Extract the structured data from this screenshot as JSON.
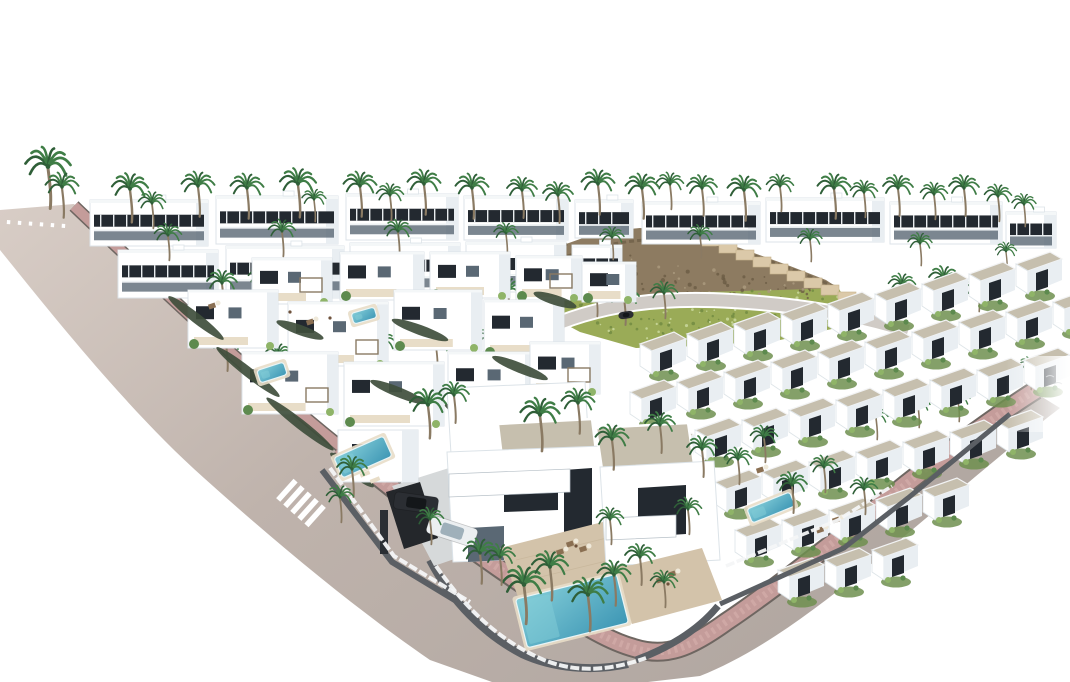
{
  "scene": {
    "description": "Aerial 3D architectural rendering of a white Mediterranean villa development with diagonal roads, pink sidewalks, crosswalks, palm trees, turquoise pools, parked cars, terraced townhouse rows and a rocky green hillside on a white background"
  },
  "colors": {
    "background": "#ffffff",
    "road_top": "#d8cdc6",
    "road_mid": "#bfb3ac",
    "road_end": "#b1a7a1",
    "street": "#d0cbc6",
    "sidewalk": "#c49c9a",
    "sidewalk_light": "#d8b3ae",
    "curb": "#6e6661",
    "wall_dark": "#5b5f64",
    "fence_white": "#f4f6f7",
    "villa_white": "#ffffff",
    "villa_shade": "#e9eef2",
    "villa_edge": "#b9c2c9",
    "window_dark": "#232930",
    "glass": "#5a6874",
    "mullion": "#e8ecef",
    "roof_gravel": "#c6bfae",
    "roof_dark": "#aaa394",
    "terrace": "#d3c3aa",
    "terrace_light": "#e8ddc8",
    "hedge": "#3f4e3c",
    "garden_green": "#6f8f4f",
    "tree_green": "#5d8a4e",
    "tree_light": "#8fb468",
    "grass": "#9aab57",
    "grass_dark": "#6f8a41",
    "grass_light": "#c8d69a",
    "rock": "#8d7b61",
    "rock_dark": "#6b5c45",
    "wall_beige": "#dbc9a9",
    "pool": "#4aa9c2",
    "pool_light": "#83cdd8",
    "palm_green": "#3f7d46",
    "palm_dark": "#2f5f38",
    "trunk": "#8a7a63",
    "car_dark": "#2b2e33",
    "car_white": "#eceff1",
    "furniture": "#8a6f52",
    "driveway": "#d6d9da",
    "carport": "#24272b"
  },
  "elements": {
    "top_buildings": [
      [
        90,
        200,
        118,
        46
      ],
      [
        216,
        196,
        122,
        48
      ],
      [
        346,
        194,
        112,
        46
      ],
      [
        464,
        196,
        104,
        44
      ],
      [
        575,
        200,
        58,
        38
      ],
      [
        642,
        202,
        118,
        42
      ],
      [
        766,
        198,
        118,
        44
      ],
      [
        890,
        202,
        112,
        42
      ],
      [
        1006,
        212,
        50,
        36
      ],
      [
        118,
        250,
        100,
        48
      ],
      [
        226,
        246,
        118,
        52
      ],
      [
        350,
        243,
        110,
        52
      ],
      [
        466,
        242,
        100,
        50
      ],
      [
        572,
        245,
        50,
        42
      ]
    ],
    "left_villas": [
      [
        252,
        258,
        80,
        46
      ],
      [
        340,
        252,
        84,
        48
      ],
      [
        430,
        252,
        80,
        46
      ],
      [
        516,
        256,
        66,
        44
      ],
      [
        582,
        262,
        54,
        40
      ],
      [
        188,
        290,
        90,
        58
      ],
      [
        288,
        302,
        100,
        64
      ],
      [
        394,
        290,
        88,
        60
      ],
      [
        484,
        300,
        80,
        56
      ],
      [
        242,
        352,
        96,
        62
      ],
      [
        344,
        362,
        100,
        64
      ],
      [
        448,
        352,
        88,
        58
      ],
      [
        530,
        342,
        70,
        52
      ]
    ],
    "townhouse_rows": [
      {
        "x": 640,
        "y": 332,
        "n": 9
      },
      {
        "x": 630,
        "y": 380,
        "n": 10
      },
      {
        "x": 648,
        "y": 428,
        "n": 10
      },
      {
        "x": 715,
        "y": 470,
        "n": 7
      },
      {
        "x": 735,
        "y": 518,
        "n": 5
      },
      {
        "x": 778,
        "y": 558,
        "n": 3
      }
    ],
    "palms_back": [
      [
        48,
        168,
        1.5
      ],
      [
        62,
        188,
        1.1
      ],
      [
        130,
        190,
        1.2
      ],
      [
        152,
        204,
        0.9
      ],
      [
        198,
        187,
        1.1
      ],
      [
        247,
        189,
        1.1
      ],
      [
        298,
        185,
        1.2
      ],
      [
        314,
        200,
        0.8
      ],
      [
        360,
        187,
        1.1
      ],
      [
        390,
        196,
        0.9
      ],
      [
        424,
        185,
        1.1
      ],
      [
        472,
        189,
        1.1
      ],
      [
        522,
        191,
        1.0
      ],
      [
        558,
        196,
        1.0
      ],
      [
        598,
        185,
        1.1
      ],
      [
        642,
        189,
        1.1
      ],
      [
        670,
        185,
        0.9
      ],
      [
        702,
        189,
        1.0
      ],
      [
        744,
        191,
        1.1
      ],
      [
        780,
        187,
        0.9
      ],
      [
        834,
        189,
        1.1
      ],
      [
        864,
        193,
        0.9
      ],
      [
        898,
        189,
        1.0
      ],
      [
        934,
        195,
        0.9
      ],
      [
        964,
        189,
        1.0
      ],
      [
        998,
        197,
        0.9
      ],
      [
        1024,
        205,
        0.8
      ],
      [
        168,
        236,
        0.9
      ],
      [
        282,
        232,
        0.9
      ],
      [
        398,
        232,
        0.9
      ],
      [
        506,
        234,
        0.8
      ],
      [
        612,
        238,
        0.8
      ],
      [
        700,
        236,
        0.8
      ],
      [
        810,
        240,
        0.8
      ],
      [
        920,
        244,
        0.8
      ],
      [
        1006,
        252,
        0.7
      ]
    ],
    "palms_mid": [
      [
        222,
        284,
        1.0
      ],
      [
        262,
        278,
        0.9
      ],
      [
        316,
        290,
        1.0
      ],
      [
        402,
        288,
        1.3
      ],
      [
        462,
        286,
        1.1
      ],
      [
        508,
        292,
        1.0
      ],
      [
        556,
        286,
        0.9
      ],
      [
        596,
        292,
        0.9
      ],
      [
        226,
        344,
        1.0
      ],
      [
        278,
        356,
        0.9
      ],
      [
        330,
        352,
        1.0
      ],
      [
        382,
        344,
        0.9
      ],
      [
        436,
        346,
        0.9
      ],
      [
        490,
        340,
        0.9
      ],
      [
        546,
        330,
        0.8
      ],
      [
        624,
        298,
        1.0
      ],
      [
        664,
        294,
        0.9
      ],
      [
        902,
        286,
        0.9
      ],
      [
        944,
        280,
        1.0
      ],
      [
        978,
        290,
        0.8
      ],
      [
        1030,
        368,
        0.8
      ],
      [
        876,
        418,
        0.8
      ],
      [
        918,
        406,
        0.8
      ],
      [
        958,
        400,
        0.8
      ]
    ],
    "palms_front": [
      [
        428,
        406,
        1.2
      ],
      [
        454,
        396,
        1.0
      ],
      [
        540,
        416,
        1.3
      ],
      [
        578,
        404,
        1.1
      ],
      [
        612,
        440,
        1.1
      ],
      [
        660,
        426,
        1.0
      ],
      [
        702,
        450,
        1.0
      ],
      [
        738,
        460,
        0.9
      ],
      [
        764,
        438,
        0.9
      ],
      [
        352,
        470,
        1.0
      ],
      [
        340,
        498,
        0.9
      ],
      [
        480,
        554,
        1.1
      ],
      [
        524,
        586,
        1.4
      ],
      [
        550,
        568,
        1.2
      ],
      [
        588,
        596,
        1.3
      ],
      [
        614,
        576,
        1.1
      ],
      [
        500,
        558,
        1.0
      ],
      [
        640,
        558,
        1.0
      ],
      [
        664,
        583,
        0.9
      ],
      [
        792,
        486,
        1.0
      ],
      [
        824,
        468,
        0.9
      ],
      [
        864,
        490,
        0.9
      ],
      [
        430,
        520,
        0.9
      ],
      [
        610,
        520,
        0.9
      ],
      [
        688,
        510,
        0.9
      ]
    ],
    "pools": [
      {
        "x": 336,
        "y": 446,
        "w": 54,
        "h": 22,
        "r": -24
      },
      {
        "x": 258,
        "y": 366,
        "w": 28,
        "h": 13,
        "r": -18
      },
      {
        "x": 352,
        "y": 310,
        "w": 24,
        "h": 11,
        "r": -16
      },
      {
        "x": 520,
        "y": 586,
        "w": 104,
        "h": 50,
        "r": -14
      },
      {
        "x": 748,
        "y": 500,
        "w": 46,
        "h": 15,
        "r": -22
      }
    ],
    "cars": [
      {
        "x": 416,
        "y": 503,
        "rot": 8,
        "type": "dark",
        "l": 44,
        "wd": 17
      },
      {
        "x": 452,
        "y": 531,
        "rot": 18,
        "type": "white",
        "l": 50,
        "wd": 19
      },
      {
        "x": 626,
        "y": 315,
        "rot": -8,
        "type": "dark",
        "l": 15,
        "wd": 7
      }
    ],
    "crosswalks": [
      {
        "cx": 36,
        "cy": 224,
        "angle": 4,
        "count": 6,
        "len": 4,
        "w": 3.4,
        "gap": 11
      },
      {
        "cx": 301,
        "cy": 503,
        "angle": 42,
        "count": 5,
        "len": 26,
        "w": 5.5,
        "gap": 9.5
      }
    ],
    "hedges": [
      {
        "x": 196,
        "y": 318,
        "l": 70,
        "rot": 38
      },
      {
        "x": 248,
        "y": 372,
        "l": 80,
        "rot": 38
      },
      {
        "x": 300,
        "y": 424,
        "l": 85,
        "rot": 38
      },
      {
        "x": 352,
        "y": 470,
        "l": 55,
        "rot": 38
      },
      {
        "x": 420,
        "y": 330,
        "l": 60,
        "rot": 20
      },
      {
        "x": 520,
        "y": 368,
        "l": 60,
        "rot": 22
      },
      {
        "x": 300,
        "y": 330,
        "l": 50,
        "rot": 20
      },
      {
        "x": 398,
        "y": 392,
        "l": 60,
        "rot": 22
      },
      {
        "x": 470,
        "y": 416,
        "l": 55,
        "rot": 24
      },
      {
        "x": 555,
        "y": 300,
        "l": 45,
        "rot": 18
      }
    ],
    "furniture": [
      [
        570,
        544
      ],
      [
        583,
        549
      ],
      [
        560,
        552
      ],
      [
        660,
        580
      ],
      [
        672,
        574
      ],
      [
        820,
        530
      ],
      [
        760,
        470
      ],
      [
        836,
        520
      ],
      [
        212,
        306
      ],
      [
        310,
        322
      ]
    ],
    "people": [
      [
        290,
        312
      ],
      [
        330,
        318
      ],
      [
        576,
        546
      ],
      [
        668,
        584
      ]
    ],
    "wall_steps": {
      "x": 702,
      "y": 236,
      "n": 9,
      "dx": 17,
      "dy": 7,
      "w": 18,
      "h": 10
    },
    "hill_quads": {
      "grass": [
        [
          543,
          300
        ],
        [
          838,
          287
        ],
        [
          850,
          326
        ],
        [
          636,
          348
        ]
      ],
      "rock": [
        [
          556,
          240
        ],
        [
          836,
          288
        ],
        [
          846,
          300
        ],
        [
          543,
          297
        ]
      ]
    }
  }
}
